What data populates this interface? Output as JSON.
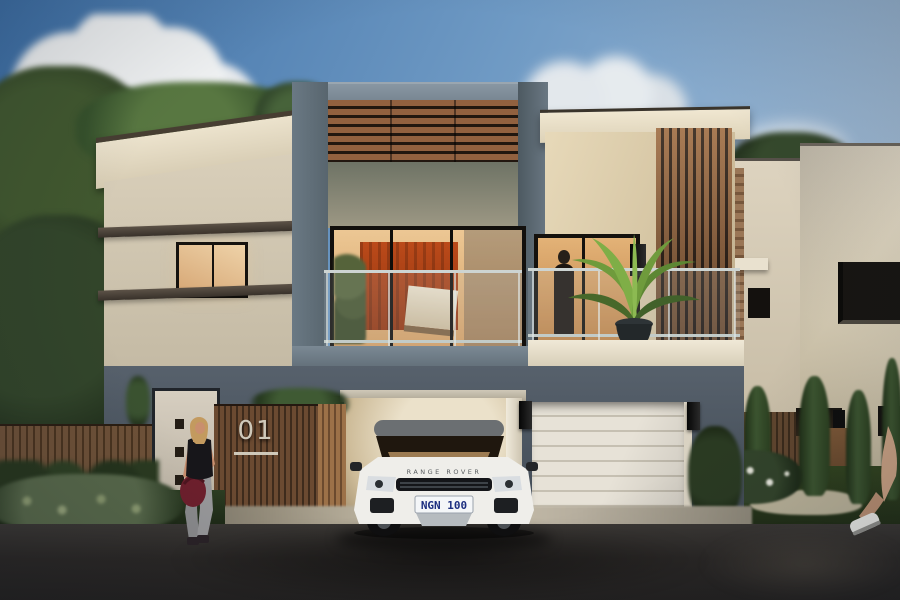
{
  "scene": {
    "type": "architectural-exterior-render",
    "house_number": "01",
    "car": {
      "brand": "RANGE ROVER",
      "plate": "NGN 100"
    }
  },
  "palette": {
    "sky-top": "#3d6fa6",
    "sky-mid": "#6f9ac4",
    "sky-low": "#b7c9db",
    "cloud": "#eef0f1",
    "cream-wall": "#d9cfba",
    "wood-slat": "#92613f",
    "wood-dark": "#22170f",
    "fence-wood": "#6b4a31",
    "fence-gap": "#3e2b1c",
    "fence-light": "#9c7148",
    "window-frame": "#15120e",
    "art-orange": "#bb4a1a",
    "garage-door": "#e7e2d7",
    "garage-line": "#c6c0b2",
    "glass-tint": "rgba(190,205,210,0.16)",
    "rail": "#cdd4d2",
    "car-white": "#efeeea",
    "plate-bg": "#f4f6f8",
    "plate-text": "#1d2f80",
    "sign-metal": "#cfc9ba"
  }
}
